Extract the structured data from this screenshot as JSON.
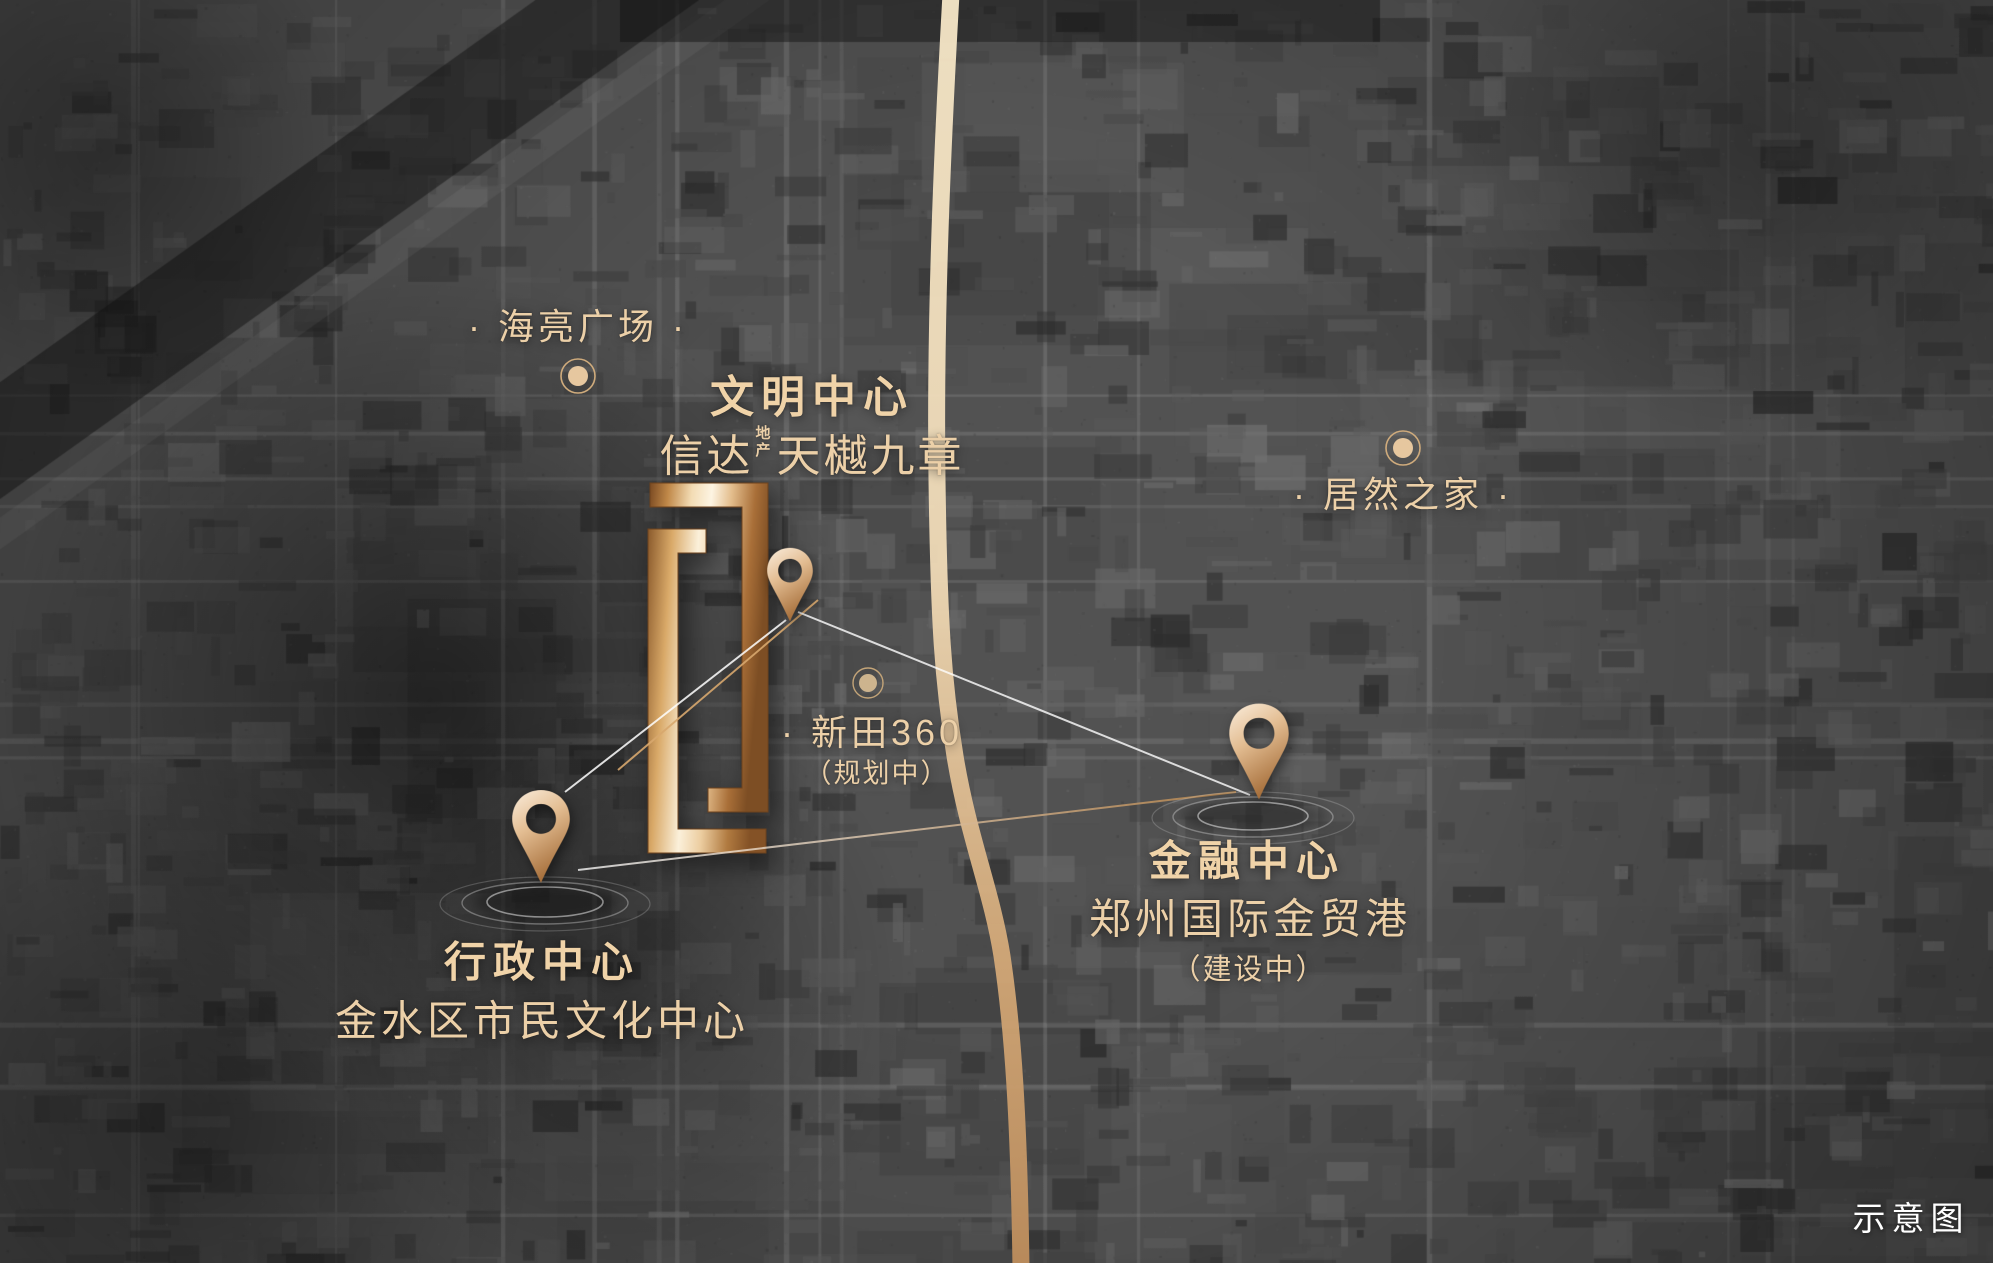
{
  "map": {
    "note_label": "示意图",
    "project": {
      "district_label": "文明中心",
      "brand": "信达",
      "brand_sup_line1": "地",
      "brand_sup_line2": "产",
      "name": "天樾九章"
    },
    "markers": {
      "admin": {
        "title": "行政中心",
        "subtitle": "金水区市民文化中心"
      },
      "finance": {
        "title": "金融中心",
        "subtitle": "郑州国际金贸港",
        "status": "（建设中）"
      }
    },
    "pois": {
      "hailiang": {
        "label": "· 海亮广场 ·"
      },
      "juran": {
        "label": "· 居然之家 ·"
      },
      "xintian": {
        "label": "· 新田360",
        "status": "（规划中）"
      }
    },
    "colors": {
      "label_text": "#ecd0a8",
      "note_text": "#ffffff",
      "road_light": "#f2e2c3",
      "road_deep": "#bd8d5c",
      "pin_gold": "#d8ad82",
      "logo_gold": "#e8c693",
      "connector_white": "#ffffff",
      "connector_gold": "#b9854a",
      "map_base_gray": "#4f4f4f"
    }
  }
}
